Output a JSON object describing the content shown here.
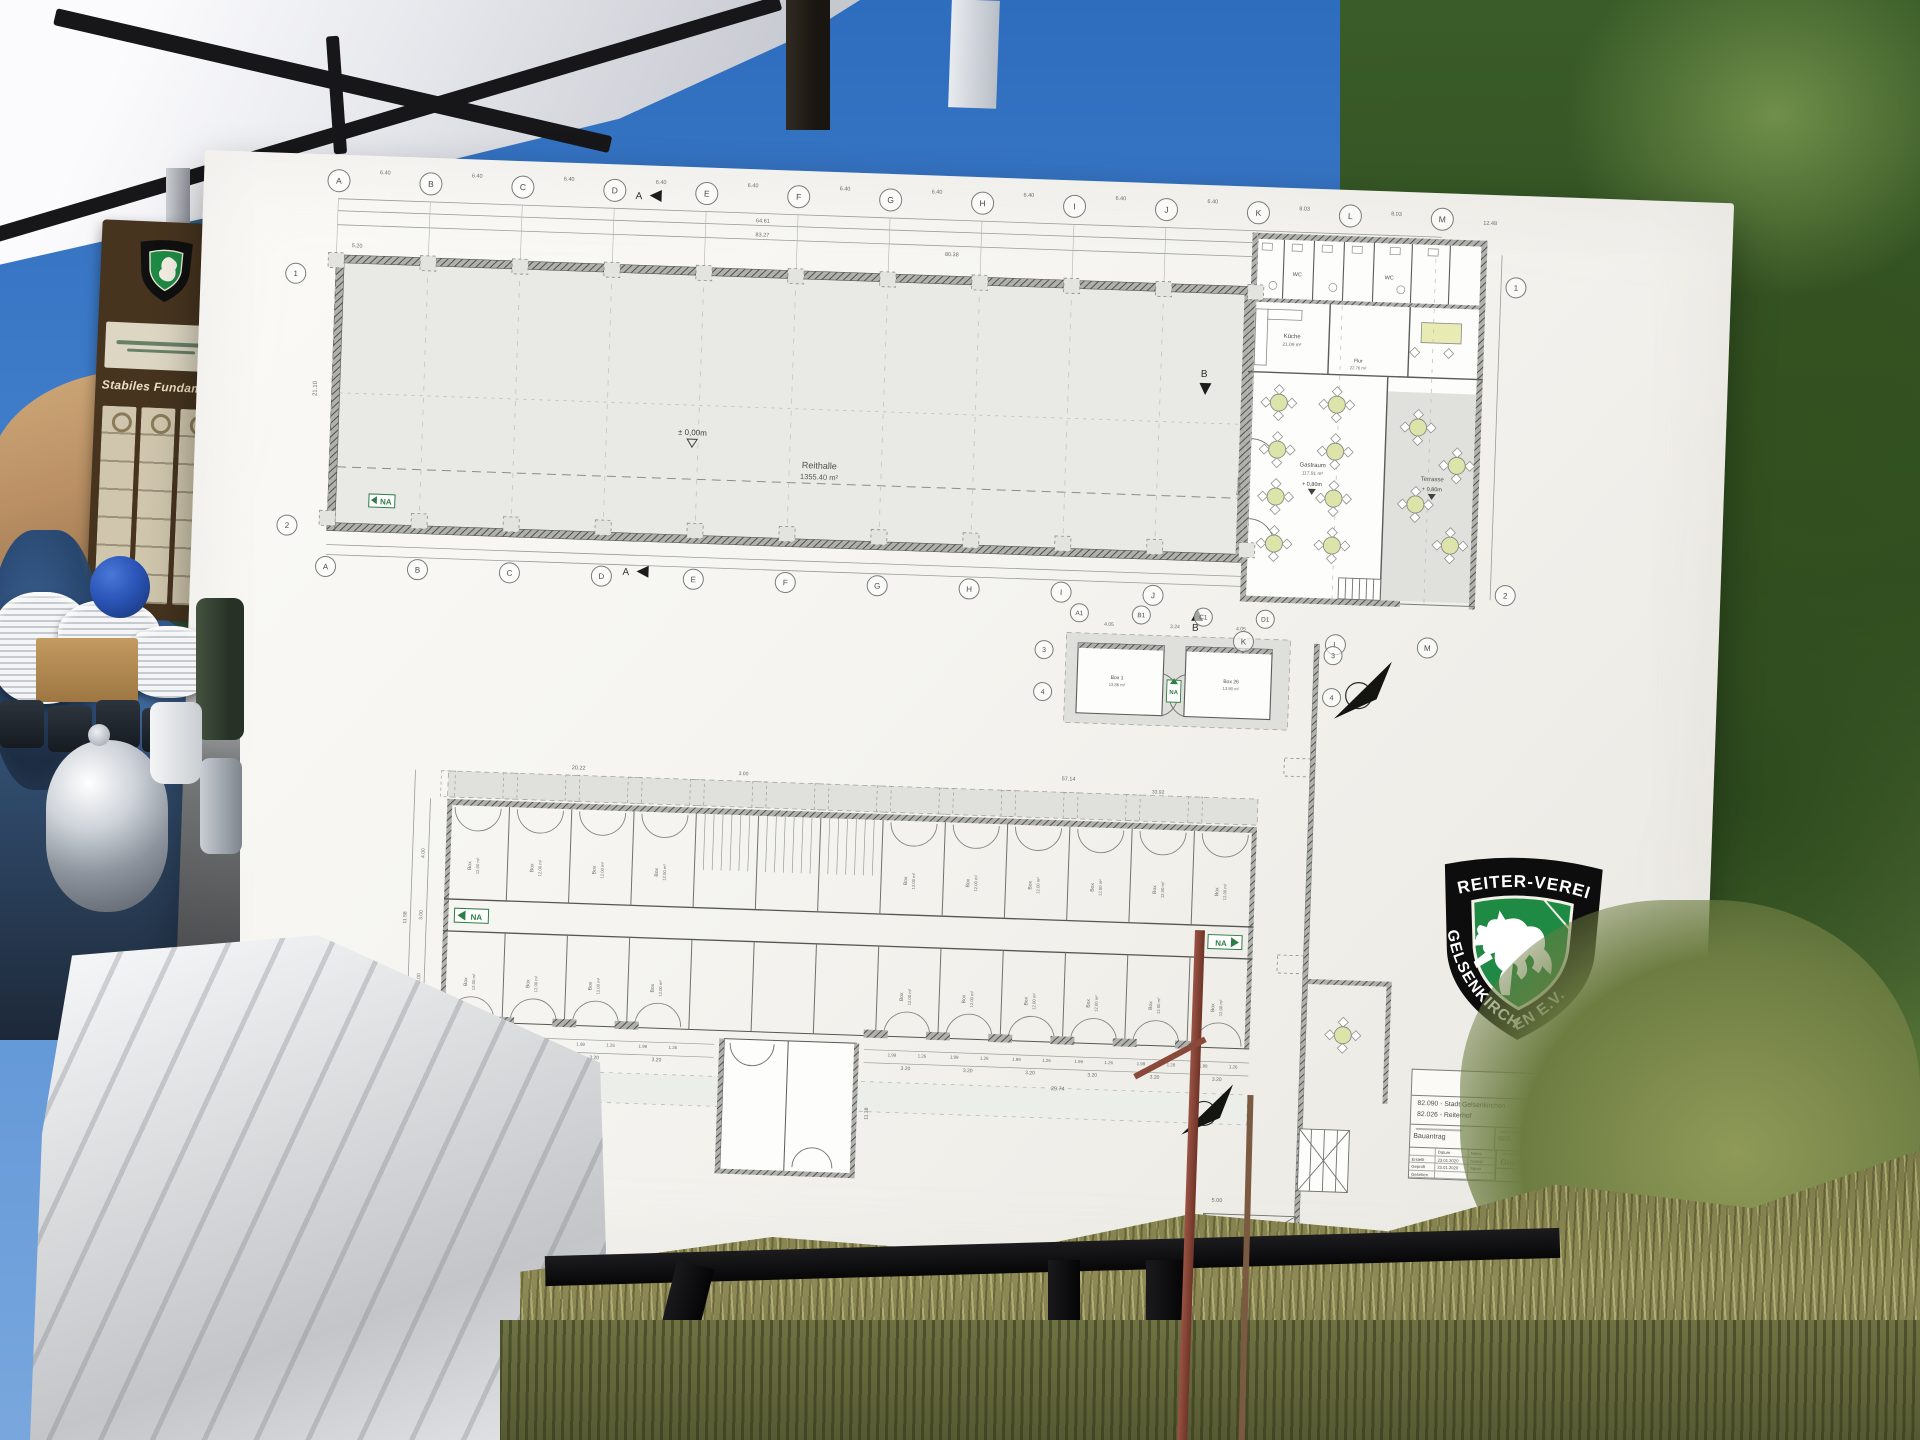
{
  "photo": {
    "banner_script": "Stabiles Fundament"
  },
  "logo": {
    "line1": "REITER-VEREIN",
    "line2": "GELSENKIRCHEN E.V."
  },
  "titleblock": {
    "company": "GELSENWASSER",
    "project1": "82.090 - Stadt Gelsenkirchen",
    "project2": "82.026 - Reiterhof",
    "doc_label": "Bauantrag",
    "number": "603",
    "org": "SBG/H",
    "org_sub": "Hochbau",
    "scale": "1:100",
    "title": "Grundriss",
    "col_date": "Datum",
    "col_name": "Name",
    "r1": "Erstellt",
    "r1d": "23.01.2020",
    "r1n": "Gefeld",
    "r2": "Geprüft",
    "r2d": "23.01.2020",
    "r2n": "Bauer",
    "r3": "Gesehen",
    "drawing_no": "Zeichnungsnummer"
  },
  "plan": {
    "grid_letters": [
      "A",
      "B",
      "C",
      "D",
      "E",
      "F",
      "G",
      "H",
      "I",
      "J",
      "K",
      "L",
      "M"
    ],
    "grid_sub": [
      "A1",
      "B1",
      "C1",
      "D1"
    ],
    "rows_main": [
      "1",
      "2"
    ],
    "rows_sub": [
      "3",
      "4"
    ],
    "span_640": "6.40",
    "span_803": "8.03",
    "span_1248": "12.48",
    "top_dims": {
      "a": "64.61",
      "b": "83.27",
      "c": "80.38"
    },
    "left_dims": {
      "a": "5.20",
      "b": "21.10"
    },
    "hall": {
      "name": "Reithalle",
      "area": "1355.40 m²",
      "level": "± 0,00m"
    },
    "level_80": "+ 0,80m",
    "annex": {
      "wc": "WC",
      "kueche": "Küche",
      "kueche_area": "21.09 m²",
      "flur": "Flur",
      "flur_area": "22.76 m²",
      "gast": "Gastraum",
      "gast_area": "117.91 m²",
      "terrasse": "Terrasse",
      "eingang": "Eingang"
    },
    "na": "NA",
    "sections": {
      "a": "A",
      "b": "B"
    },
    "out": {
      "box1": "Box 1",
      "box1_area": "13.86 m²",
      "box26": "Box 26",
      "box26_area": "13.80 m²",
      "d1": "4.05",
      "d2": "3.24"
    },
    "stable": {
      "box_label": "Box",
      "box_area": "12.00 m²",
      "unit_a": "1.99",
      "unit_b": "1.26",
      "unit_w": "3.20",
      "unit_w2": "3.00",
      "total_left": "16.04",
      "total_right": "29.74",
      "top_left": "20.22",
      "top_total": "57.14",
      "top_part": "33.92",
      "gap": "3.00",
      "v1": "4.00",
      "v2": "3.00",
      "v3": "4.00",
      "v_total": "11.58",
      "v_total2": "8.24",
      "ext": "11.38",
      "fence": "5.00"
    }
  }
}
